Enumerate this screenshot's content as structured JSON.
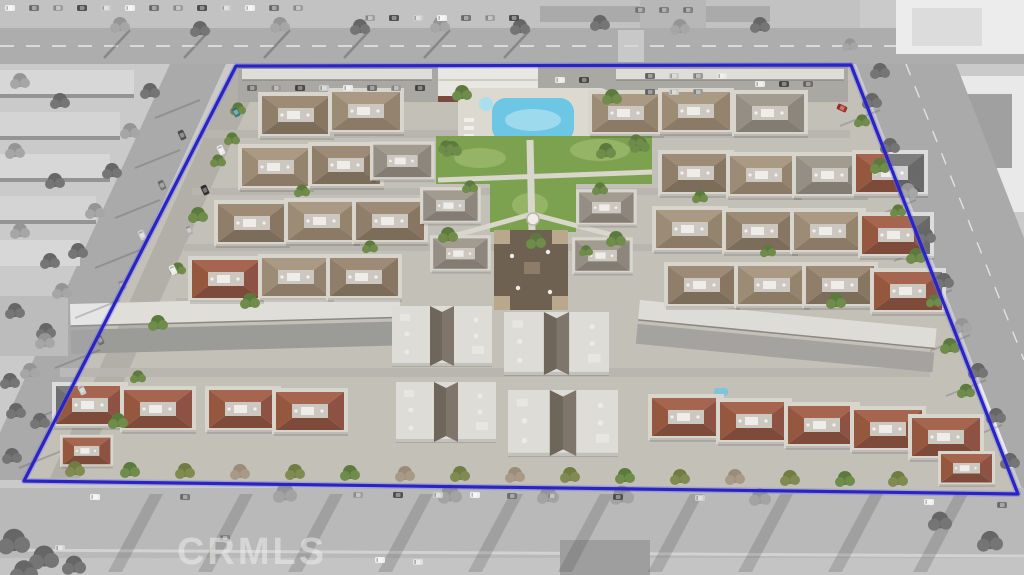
{
  "watermark": {
    "text": "CRMLS",
    "color": "#ededec",
    "opacity": 0.55
  },
  "annotation": {
    "boundary_color": "#2b24c4"
  },
  "scene": {
    "description": "Oblique aerial photo of a large condominium community; property outlined with a blue boundary line, interior in color, surrounding streets and lots desaturated to grayscale",
    "colors": {
      "pool": "#6cc6e4",
      "pool_light": "#aadff0",
      "lawn": "#7da24f",
      "lawn_light": "#95b465",
      "deck": "#dcd9d0",
      "pavement": "#c7c4bc",
      "street": "#a9a7a3",
      "carport": "#dfddd7",
      "roof_brown_n": "#9d8b76",
      "roof_brown_s": "#7c6c5a",
      "roof_brown_w": "#8f7e6a",
      "roof_brown_e": "#887663",
      "roof_tan_n": "#aa9a84",
      "roof_tan_s": "#8a7a66",
      "roof_tan_w": "#9c8c76",
      "roof_tan_e": "#94846e",
      "roof_gray_n": "#a29c90",
      "roof_gray_s": "#827c72",
      "roof_gray_w": "#948e84",
      "roof_gray_e": "#8c867c",
      "roof_red_n": "#a5654f",
      "roof_red_s": "#7e4a39",
      "roof_red_w": "#96573f",
      "roof_red_e": "#8e5244",
      "tree_green": "#5d7a3e",
      "tree_green2": "#6f8c4a",
      "tree_olive": "#707c42",
      "tree_olive2": "#7f8b50",
      "tree_gray": "#8f8f8b",
      "tree_gray2": "#a0a09c",
      "tree_dark": "#5f5f5b",
      "tree_dark2": "#6e6e6a",
      "tree_bare": "#9a8c79",
      "tree_bare2": "#a89a86"
    }
  }
}
